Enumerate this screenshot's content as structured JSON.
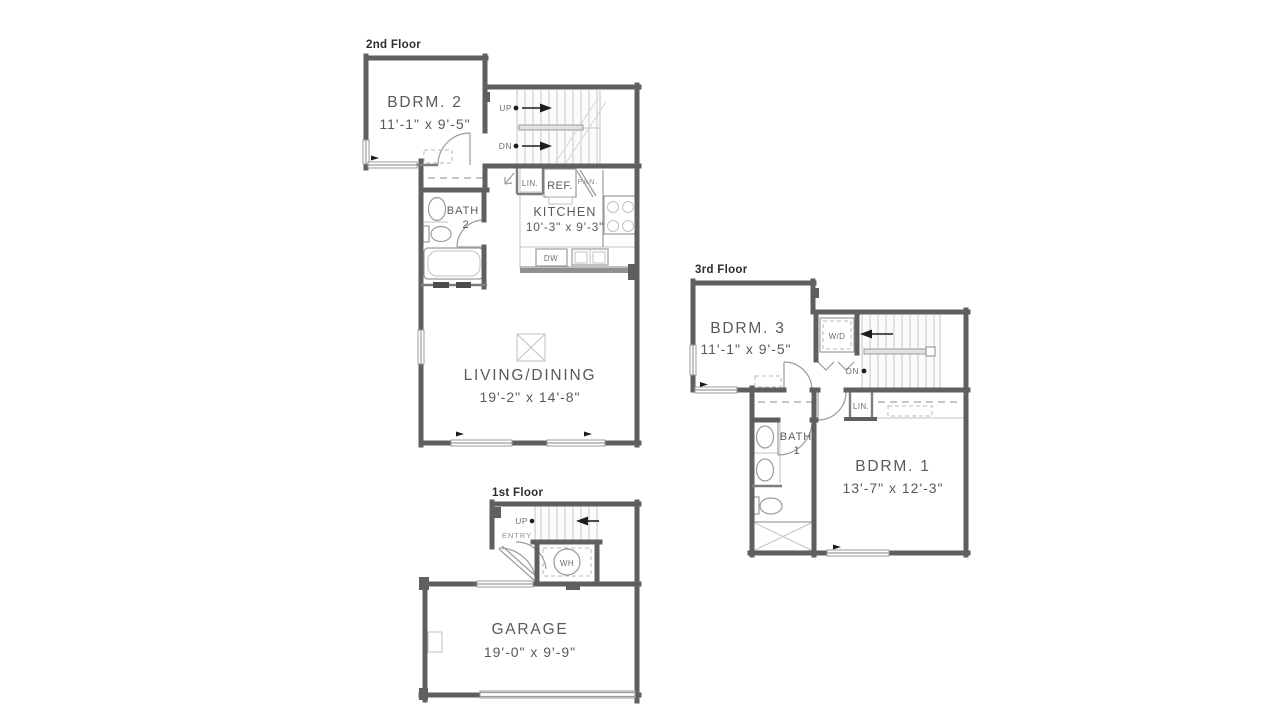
{
  "colors": {
    "wall": "#5f5f5f",
    "line": "#9b9b9b",
    "text": "#5a5a5a",
    "accent": "#1d1d1d",
    "background": "#ffffff"
  },
  "floors": {
    "second": {
      "label": "2nd Floor",
      "bdrm2_name": "BDRM. 2",
      "bdrm2_dims": "11'-1\" x 9'-5\"",
      "bath_name": "BATH",
      "bath_num": "2",
      "kitchen_name": "KITCHEN",
      "kitchen_dims": "10'-3\" x 9'-3\"",
      "living_name": "LIVING/DINING",
      "living_dims": "19'-2\" x 14'-8\"",
      "up": "UP",
      "dn": "DN",
      "lin": "LIN.",
      "ref": "REF.",
      "pan": "PAN.",
      "dw": "DW"
    },
    "third": {
      "label": "3rd Floor",
      "bdrm3_name": "BDRM. 3",
      "bdrm3_dims": "11'-1\" x 9'-5\"",
      "bath_name": "BATH",
      "bath_num": "1",
      "bdrm1_name": "BDRM. 1",
      "bdrm1_dims": "13'-7\" x 12'-3\"",
      "wd": "W/D",
      "dn": "DN",
      "lin": "LIN."
    },
    "first": {
      "label": "1st Floor",
      "garage_name": "GARAGE",
      "garage_dims": "19'-0\" x 9'-9\"",
      "up": "UP",
      "entry": "ENTRY",
      "wh": "WH"
    }
  }
}
